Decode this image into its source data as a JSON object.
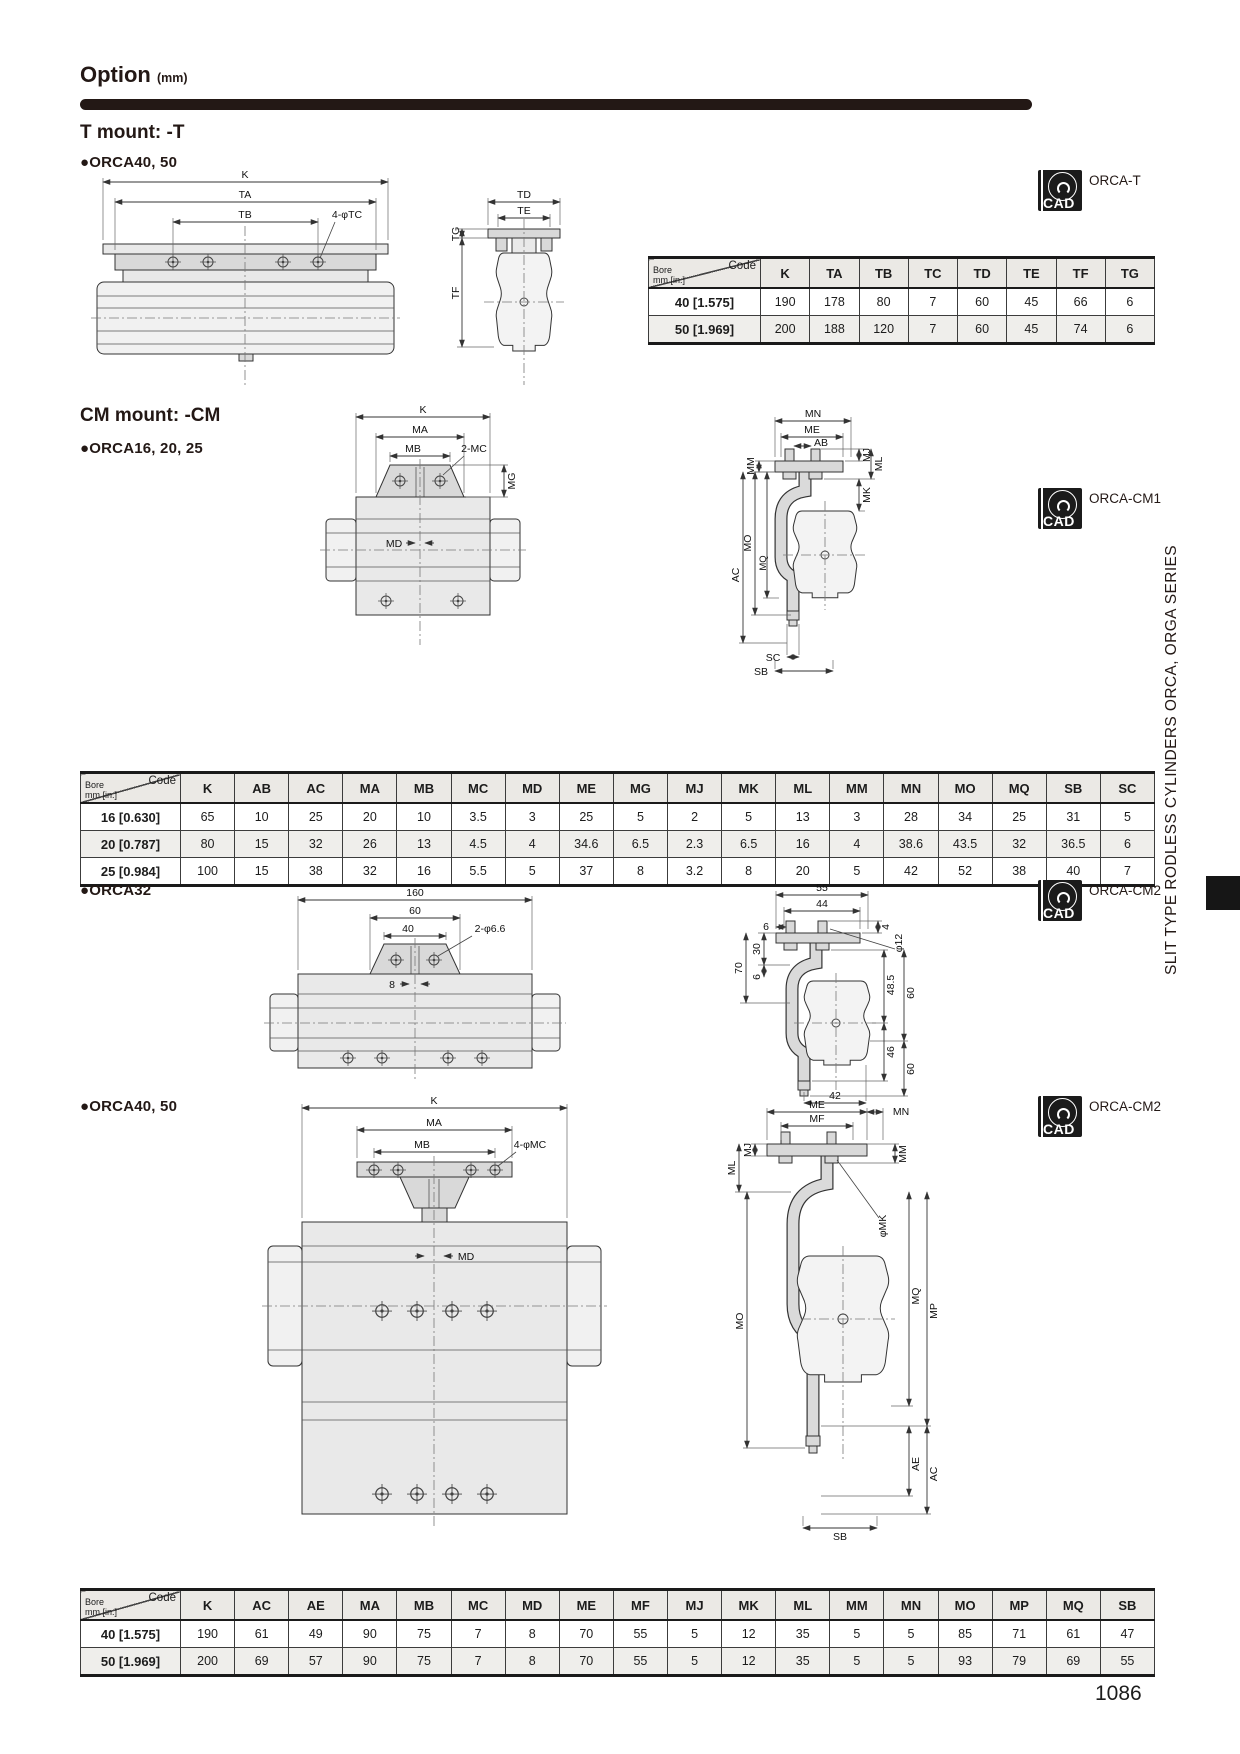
{
  "page": {
    "header_title": "Option",
    "header_unit": "(mm)",
    "cad_text": "CAD",
    "side_text": "SLIT TYPE RODLESS CYLINDERS ORCA, ORGA SERIES",
    "page_number": "1086"
  },
  "sections": {
    "tmount": {
      "title": "T mount: -T",
      "model": "●ORCA40, 50",
      "cad_ref": "ORCA-T",
      "front_labels": {
        "k": "K",
        "ta": "TA",
        "tb": "TB",
        "tc": "4-φTC"
      },
      "side_labels": {
        "td": "TD",
        "te": "TE",
        "tg": "TG",
        "tf": "TF"
      },
      "table": {
        "corner": {
          "code": "Code",
          "bore": "Bore",
          "unit": "mm [in.]"
        },
        "headers": [
          "K",
          "TA",
          "TB",
          "TC",
          "TD",
          "TE",
          "TF",
          "TG"
        ],
        "rows": [
          {
            "bore": "40 [1.575]",
            "values": [
              "190",
              "178",
              "80",
              "7",
              "60",
              "45",
              "66",
              "6"
            ]
          },
          {
            "bore": "50 [1.969]",
            "values": [
              "200",
              "188",
              "120",
              "7",
              "60",
              "45",
              "74",
              "6"
            ]
          }
        ]
      }
    },
    "cm_small": {
      "title": "CM mount: -CM",
      "model": "●ORCA16, 20, 25",
      "cad_ref": "ORCA-CM1",
      "front_labels": {
        "k": "K",
        "ma": "MA",
        "mb": "MB",
        "mc": "2-MC",
        "mg": "MG",
        "md": "MD"
      },
      "side_labels": {
        "mn": "MN",
        "me": "ME",
        "mm": "MM",
        "ab": "AB",
        "mj": "MJ",
        "ml": "ML",
        "mk": "MK",
        "mo": "MO",
        "mq": "MQ",
        "ac": "AC",
        "sc": "SC",
        "sb": "SB"
      },
      "table": {
        "corner": {
          "code": "Code",
          "bore": "Bore",
          "unit": "mm [in.]"
        },
        "headers": [
          "K",
          "AB",
          "AC",
          "MA",
          "MB",
          "MC",
          "MD",
          "ME",
          "MG",
          "MJ",
          "MK",
          "ML",
          "MM",
          "MN",
          "MO",
          "MQ",
          "SB",
          "SC"
        ],
        "rows": [
          {
            "bore": "16 [0.630]",
            "values": [
              "65",
              "10",
              "25",
              "20",
              "10",
              "3.5",
              "3",
              "25",
              "5",
              "2",
              "5",
              "13",
              "3",
              "28",
              "34",
              "25",
              "31",
              "5"
            ]
          },
          {
            "bore": "20 [0.787]",
            "values": [
              "80",
              "15",
              "32",
              "26",
              "13",
              "4.5",
              "4",
              "34.6",
              "6.5",
              "2.3",
              "6.5",
              "16",
              "4",
              "38.6",
              "43.5",
              "32",
              "36.5",
              "6"
            ]
          },
          {
            "bore": "25 [0.984]",
            "values": [
              "100",
              "15",
              "38",
              "32",
              "16",
              "5.5",
              "5",
              "37",
              "8",
              "3.2",
              "8",
              "20",
              "5",
              "42",
              "52",
              "38",
              "40",
              "7"
            ]
          }
        ]
      }
    },
    "orca32": {
      "model": "●ORCA32",
      "cad_ref": "ORCA-CM2",
      "front_labels": {
        "w160": "160",
        "w60": "60",
        "w40": "40",
        "holes": "2-φ6.6",
        "d8": "8"
      },
      "side_labels": {
        "d55": "55",
        "d44": "44",
        "d6a": "6",
        "d30": "30",
        "d6b": "6",
        "d70": "70",
        "d4": "4",
        "d12": "φ12",
        "d485": "48.5",
        "d60a": "60",
        "d46": "46",
        "d60b": "60",
        "d42": "42"
      }
    },
    "cm_large": {
      "model": "●ORCA40, 50",
      "cad_ref": "ORCA-CM2",
      "front_labels": {
        "k": "K",
        "ma": "MA",
        "mb": "MB",
        "mc": "4-φMC",
        "md": "MD"
      },
      "side_labels": {
        "me": "ME",
        "mn": "MN",
        "mf": "MF",
        "mj": "MJ",
        "ml": "ML",
        "mm": "MM",
        "mo": "MO",
        "mk": "φMK",
        "mq": "MQ",
        "mp": "MP",
        "ae": "AE",
        "ac": "AC",
        "sb": "SB"
      },
      "table": {
        "corner": {
          "code": "Code",
          "bore": "Bore",
          "unit": "mm [in.]"
        },
        "headers": [
          "K",
          "AC",
          "AE",
          "MA",
          "MB",
          "MC",
          "MD",
          "ME",
          "MF",
          "MJ",
          "MK",
          "ML",
          "MM",
          "MN",
          "MO",
          "MP",
          "MQ",
          "SB"
        ],
        "rows": [
          {
            "bore": "40 [1.575]",
            "values": [
              "190",
              "61",
              "49",
              "90",
              "75",
              "7",
              "8",
              "70",
              "55",
              "5",
              "12",
              "35",
              "5",
              "5",
              "85",
              "71",
              "61",
              "47"
            ]
          },
          {
            "bore": "50 [1.969]",
            "values": [
              "200",
              "69",
              "57",
              "90",
              "75",
              "7",
              "8",
              "70",
              "55",
              "5",
              "12",
              "35",
              "5",
              "5",
              "93",
              "79",
              "69",
              "55"
            ]
          }
        ]
      }
    }
  }
}
